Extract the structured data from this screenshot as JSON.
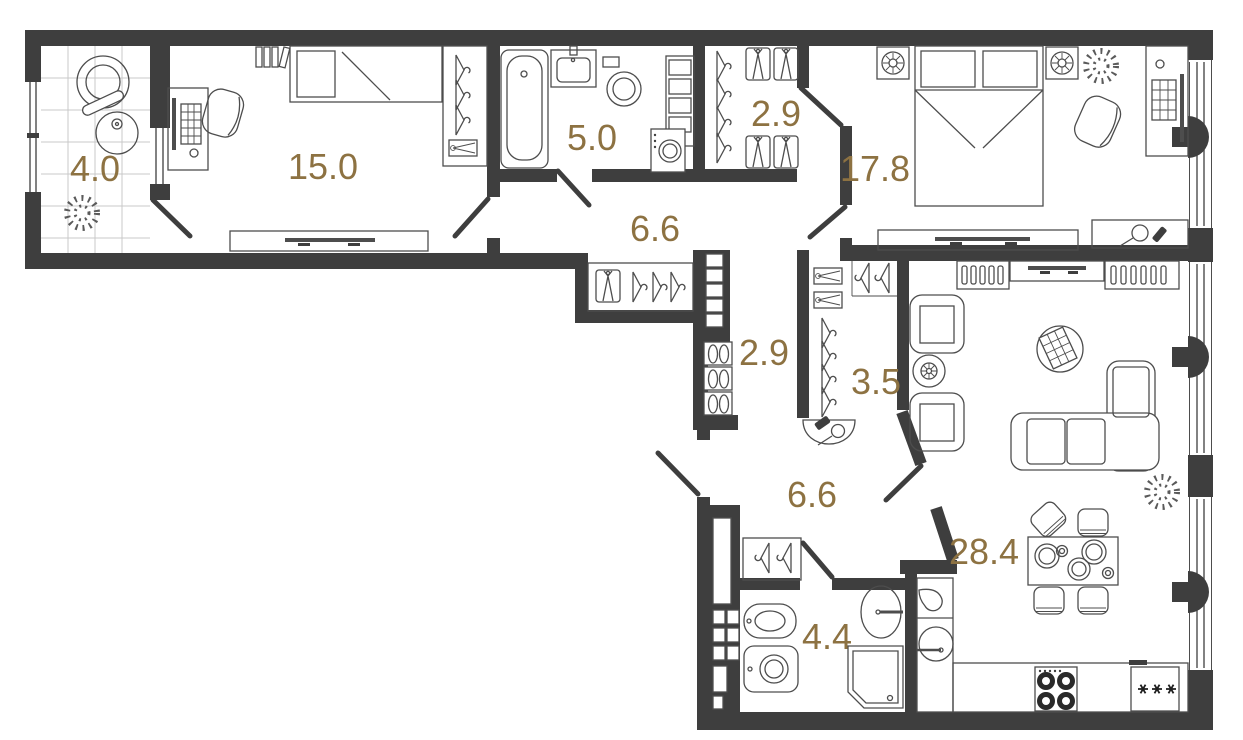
{
  "rooms": [
    {
      "name": "loggia",
      "area": "4.0"
    },
    {
      "name": "bedroom",
      "area": "15.0"
    },
    {
      "name": "bathroom",
      "area": "5.0"
    },
    {
      "name": "closet-top",
      "area": "2.9"
    },
    {
      "name": "master-bedroom",
      "area": "17.8"
    },
    {
      "name": "hallway-upper",
      "area": "6.6"
    },
    {
      "name": "corridor",
      "area": "2.9"
    },
    {
      "name": "wardrobe",
      "area": "3.5"
    },
    {
      "name": "entrance-hall",
      "area": "6.6"
    },
    {
      "name": "living-kitchen",
      "area": "28.4"
    },
    {
      "name": "bathroom-lower",
      "area": "4.4"
    }
  ],
  "colors": {
    "wall": "#3e3e3e",
    "furniture_line": "#4d4d4d",
    "label": "#8d7242",
    "tile_grid": "#c9c9c9",
    "background": "#ffffff"
  },
  "icons": [
    "bathtub-icon",
    "toilet-icon",
    "bidet-icon",
    "shower-icon",
    "sink-icon",
    "washing-machine-icon",
    "single-bed-icon",
    "double-bed-icon",
    "pillow-icon",
    "wardrobe-hanger-icon",
    "shirt-icon",
    "shoe-shelf-icon",
    "desk-icon",
    "monitor-icon",
    "keyboard-icon",
    "chair-icon",
    "armchair-icon",
    "sofa-icon",
    "rug-icon",
    "tv-console-icon",
    "nightstand-lamp-icon",
    "plant-icon",
    "dining-table-icon",
    "cooktop-icon",
    "fridge-icon",
    "kitchen-sink-icon",
    "door-leaf-icon",
    "window-icon",
    "radiator-column-icon",
    "entry-mat-icon",
    "shoehorn-icon",
    "drawer-box-icon",
    "shelf-column-icon",
    "dressing-table-icon"
  ]
}
